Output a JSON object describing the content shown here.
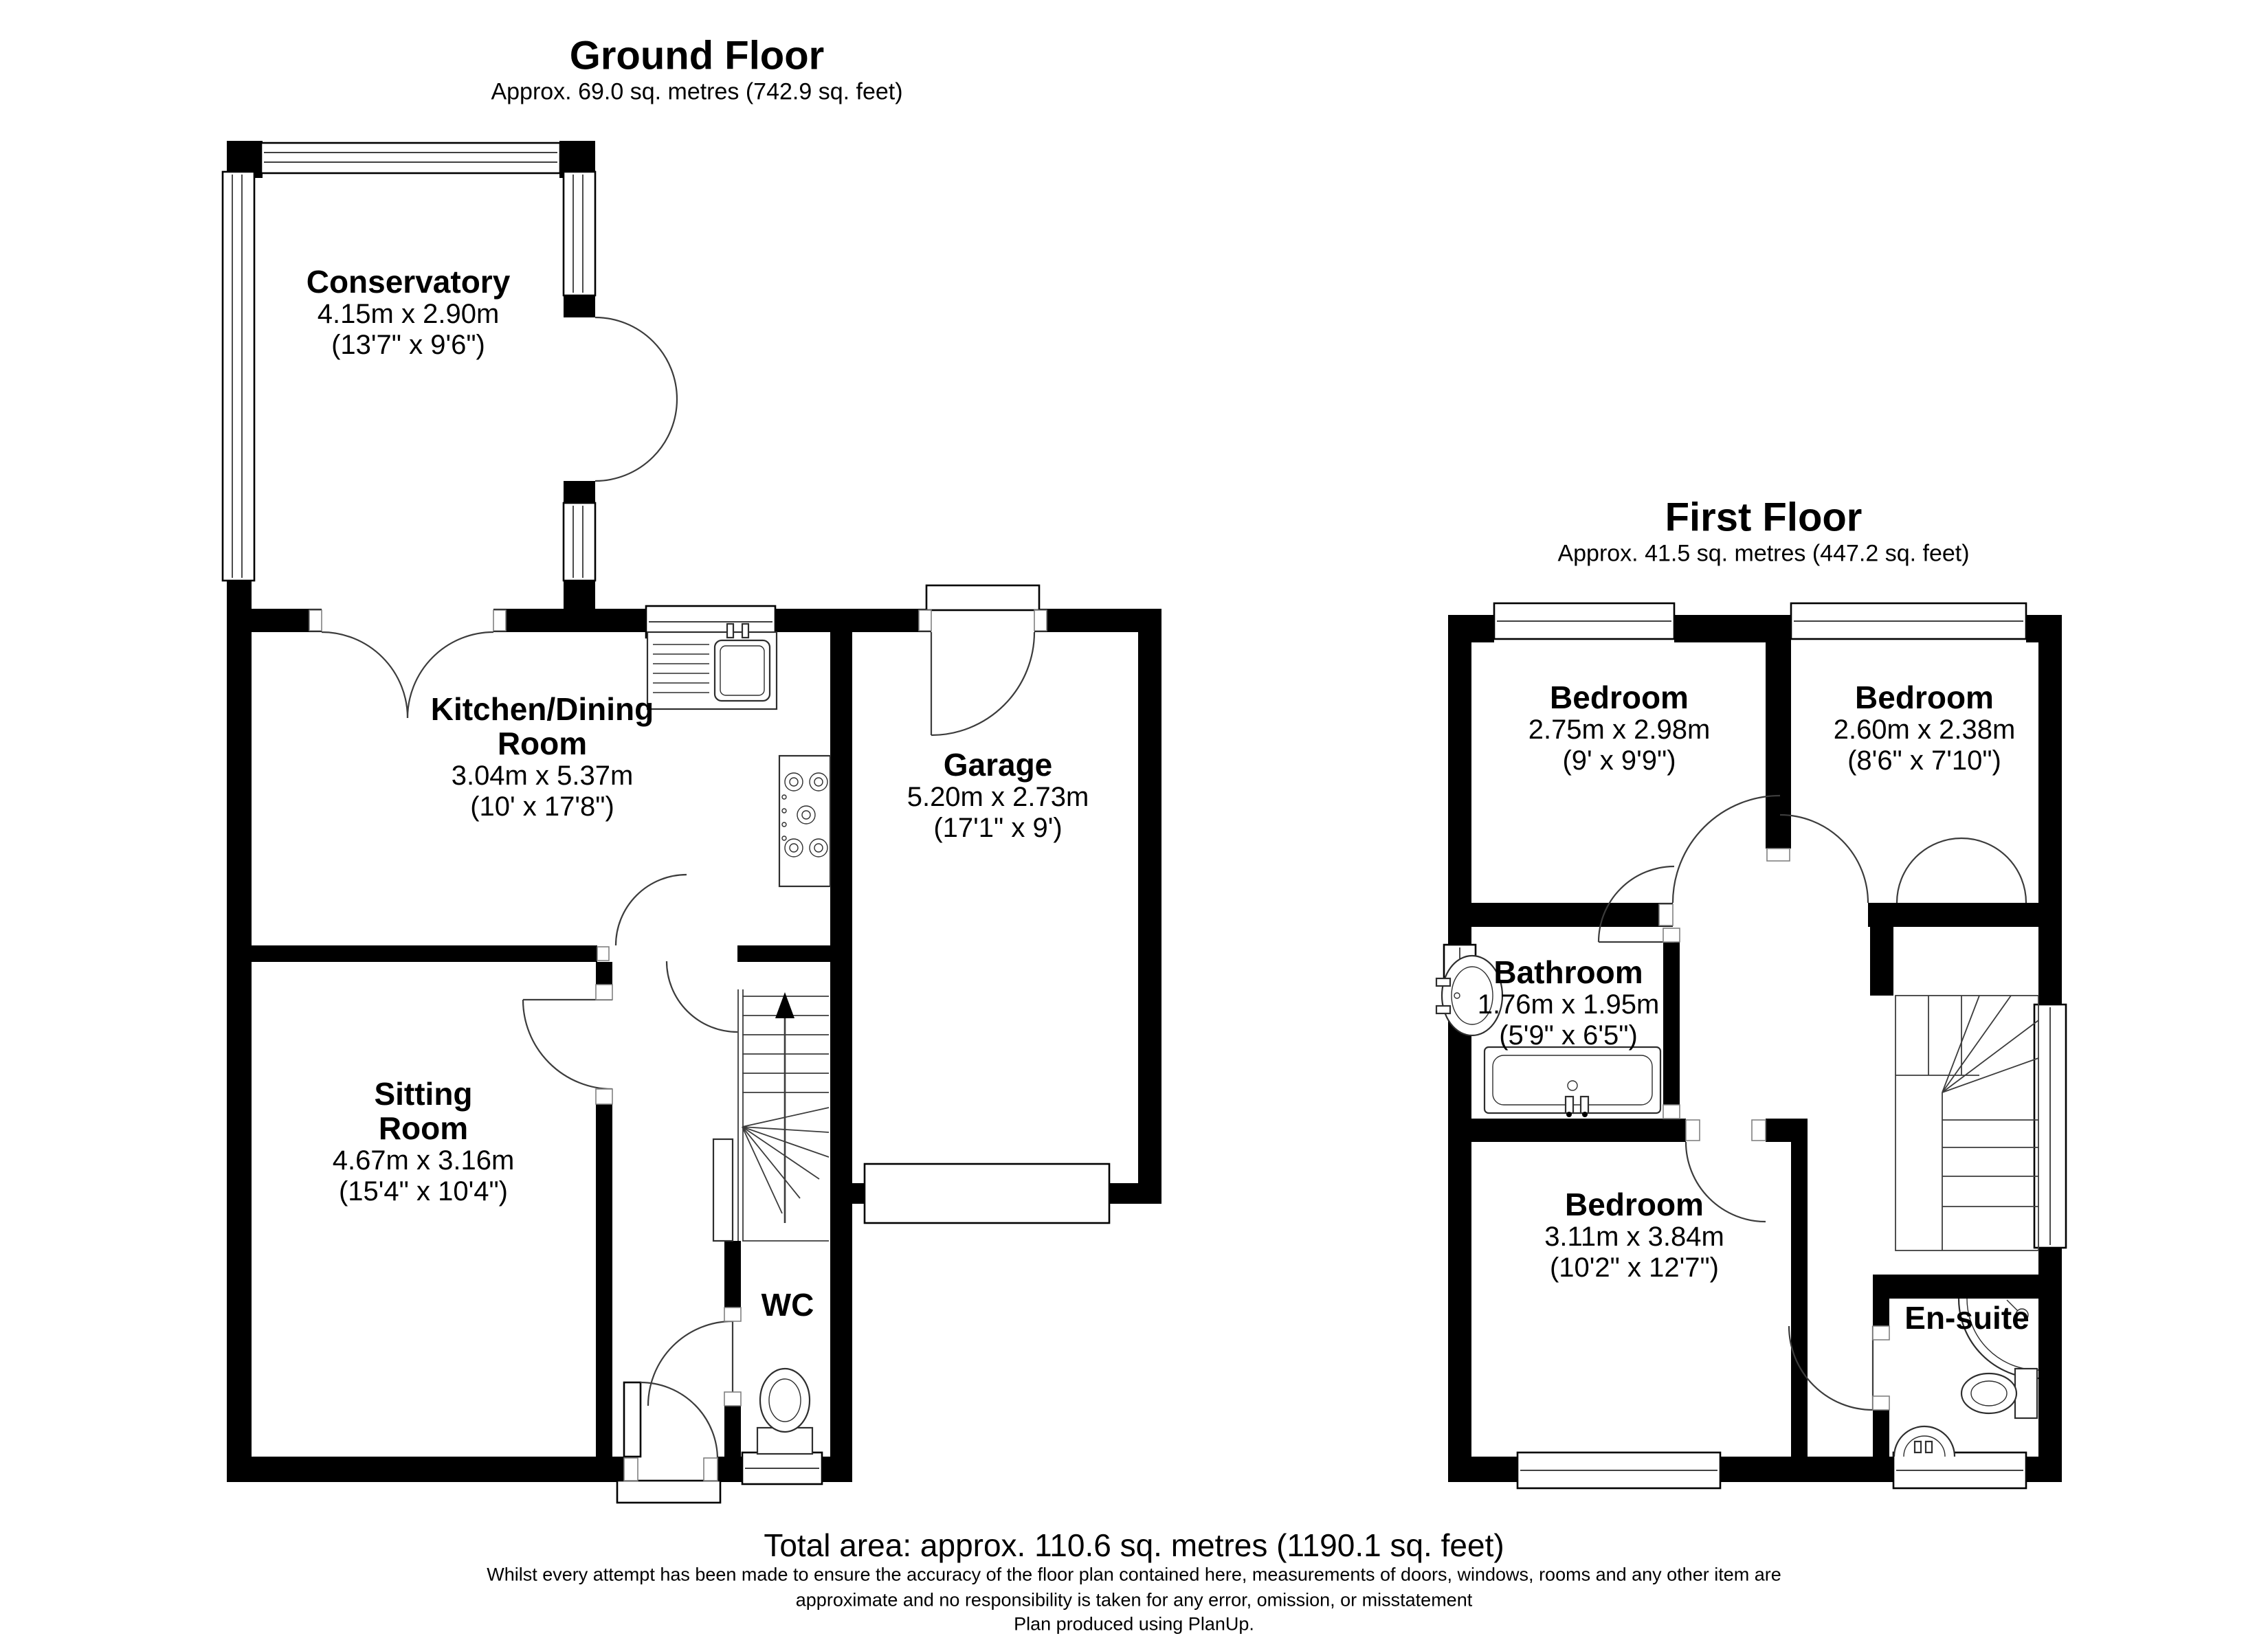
{
  "ground_floor": {
    "title": "Ground Floor",
    "area": "Approx. 69.0 sq. metres (742.9 sq. feet)",
    "rooms": {
      "conservatory": {
        "name": "Conservatory",
        "metric": "4.15m x 2.90m",
        "imperial": "(13'7\" x 9'6\")"
      },
      "kitchen": {
        "name": "Kitchen/Dining Room",
        "metric": "3.04m x 5.37m",
        "imperial": "(10' x 17'8\")"
      },
      "garage": {
        "name": "Garage",
        "metric": "5.20m x 2.73m",
        "imperial": "(17'1\" x 9')"
      },
      "sitting": {
        "name": "Sitting Room",
        "metric": "4.67m x 3.16m",
        "imperial": "(15'4\" x 10'4\")"
      },
      "wc": {
        "name": "WC"
      }
    }
  },
  "first_floor": {
    "title": "First Floor",
    "area": "Approx. 41.5 sq. metres (447.2 sq. feet)",
    "rooms": {
      "bedroom1": {
        "name": "Bedroom",
        "metric": "2.75m x 2.98m",
        "imperial": "(9' x 9'9\")"
      },
      "bedroom2": {
        "name": "Bedroom",
        "metric": "2.60m x 2.38m",
        "imperial": "(8'6\" x 7'10\")"
      },
      "bathroom": {
        "name": "Bathroom",
        "metric": "1.76m x 1.95m",
        "imperial": "(5'9\" x 6'5\")"
      },
      "bedroom3": {
        "name": "Bedroom",
        "metric": "3.11m x 3.84m",
        "imperial": "(10'2\" x 12'7\")"
      },
      "ensuite": {
        "name": "En-suite"
      }
    }
  },
  "footer": {
    "total_area": "Total area: approx. 110.6 sq. metres (1190.1 sq. feet)",
    "disclaimer": [
      "Whilst every attempt has been made to ensure the accuracy of the floor plan contained here, measurements of doors, windows, rooms and any other item are",
      "approximate and no responsibility is taken for any error, omission, or misstatement",
      "Plan produced using PlanUp."
    ]
  },
  "colors": {
    "wall": "#000000",
    "background": "#ffffff",
    "text": "#000000"
  }
}
